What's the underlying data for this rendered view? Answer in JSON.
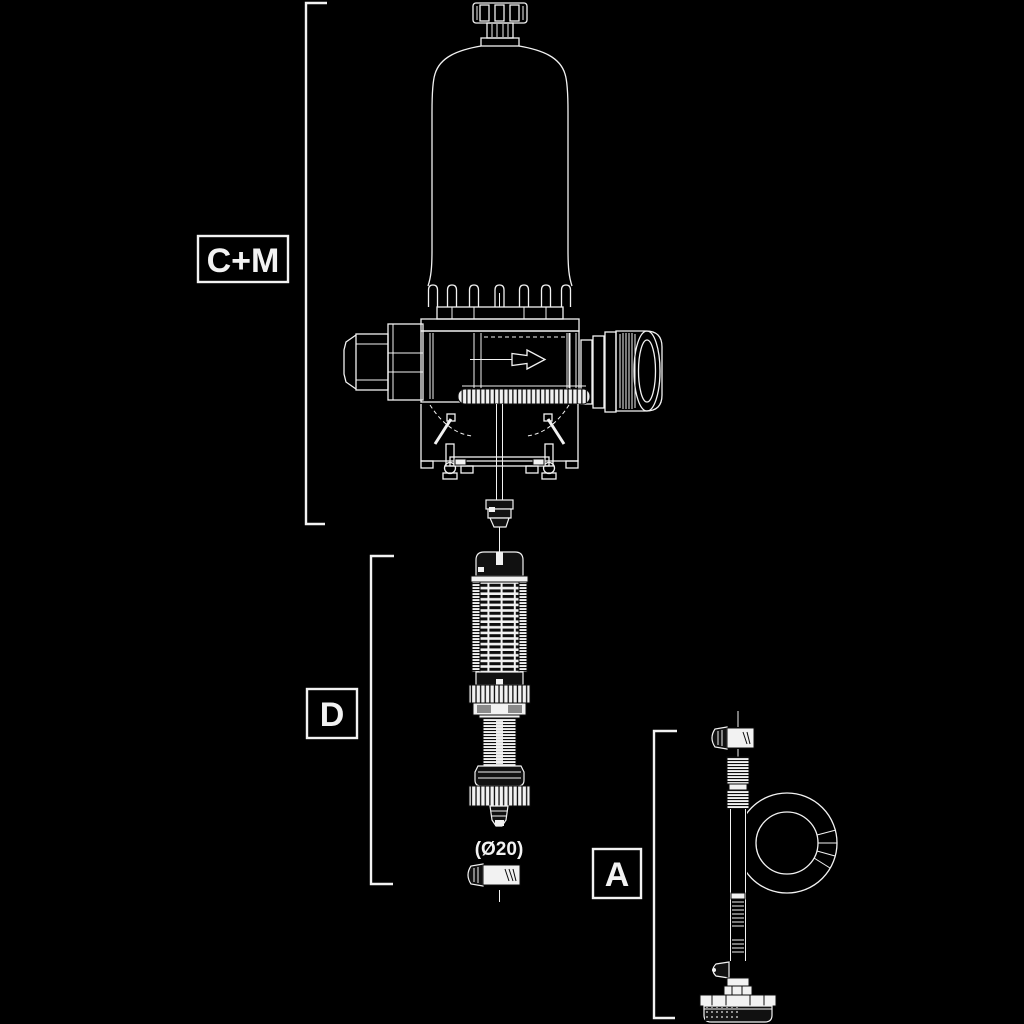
{
  "theme": {
    "background": "#000000",
    "line_color": "#f2f2f2",
    "detail_line_color": "#0d0d0d"
  },
  "diagram": {
    "dimension_labels": {
      "pump_assembly": "C+M",
      "suction_assembly": "D",
      "suction_tube_assembly": "A"
    },
    "annotations": {
      "diameter_note": "(Ø20)"
    },
    "icons": {
      "flow_arrow": "right-arrow"
    }
  }
}
